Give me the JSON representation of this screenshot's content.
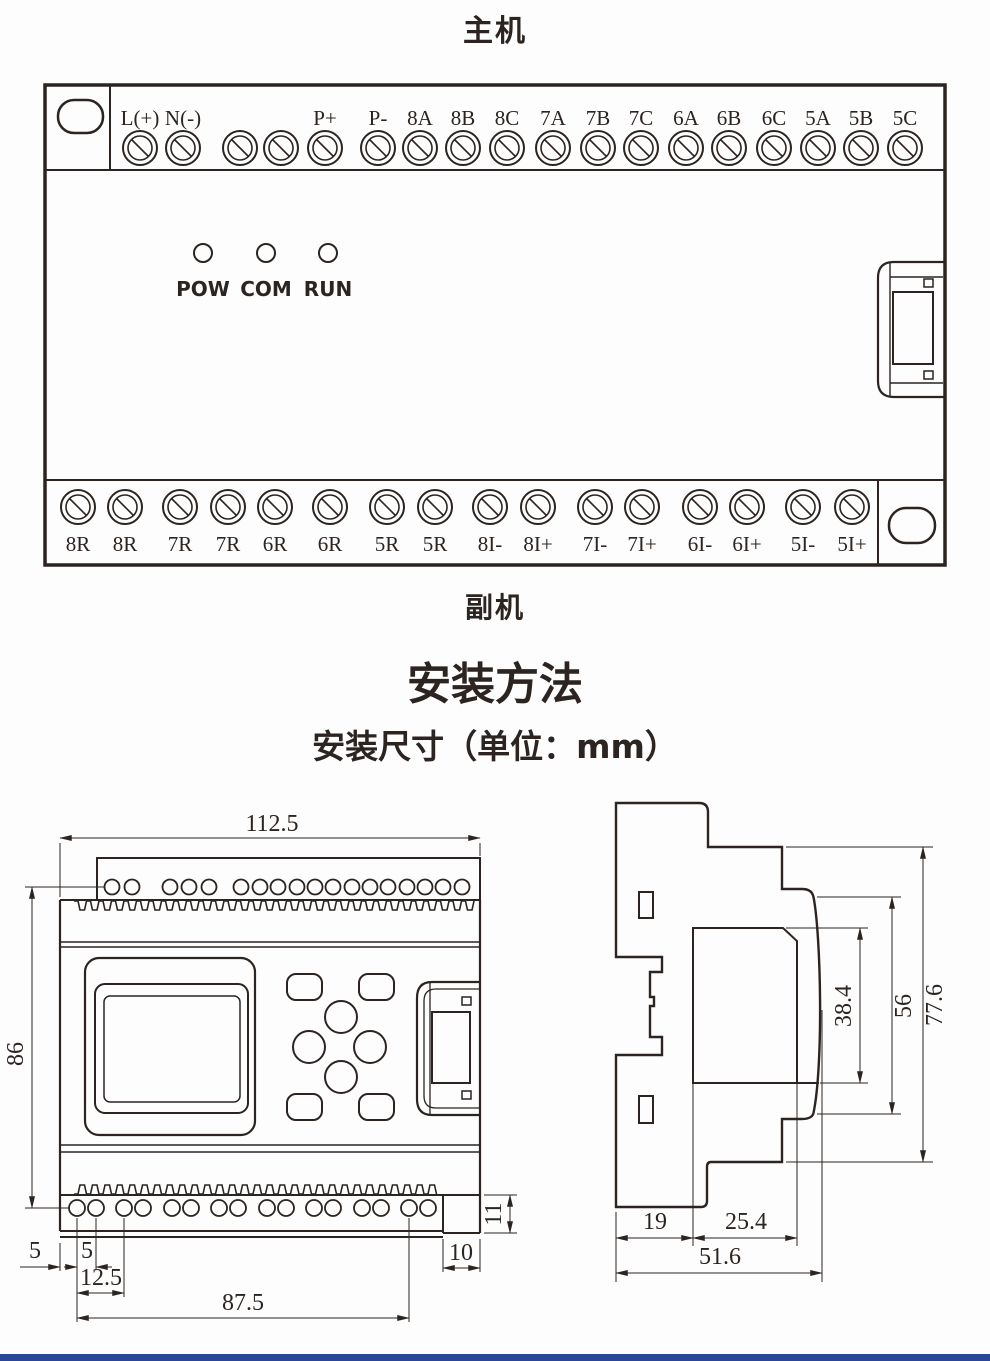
{
  "page": {
    "background": "#fdfdfd",
    "line_color": "#2b2420",
    "footer_bar_color": "#2a4795"
  },
  "titles": {
    "main_unit": "主机",
    "sub_unit": "副机",
    "install_section": "安装方法",
    "dims_section": "安装尺寸（单位：mm）"
  },
  "main_unit": {
    "top_terminals": [
      "L(+)",
      "N(-)",
      "",
      "",
      "P+",
      "P-",
      "8A",
      "8B",
      "8C",
      "7A",
      "7B",
      "7C",
      "6A",
      "6B",
      "6C",
      "5A",
      "5B",
      "5C"
    ],
    "leds": [
      "POW",
      "COM",
      "RUN"
    ],
    "bottom_terminals": [
      "8R",
      "8R",
      "7R",
      "7R",
      "6R",
      "6R",
      "5R",
      "5R",
      "8I-",
      "8I+",
      "7I-",
      "7I+",
      "6I-",
      "6I+",
      "5I-",
      "5I+"
    ]
  },
  "front_view": {
    "dim_width": "112.5",
    "dim_height": "86",
    "dim_edge_to_hole": "5",
    "dim_hole_pitch": "5",
    "dim_first_group": "12.5",
    "dim_hole_span": "87.5",
    "dim_tab_width": "10",
    "dim_tab_height": "11"
  },
  "side_view": {
    "dim_panel_height": "38.4",
    "dim_body_height": "56",
    "dim_total_height": "77.6",
    "dim_left_depth": "19",
    "dim_mid_depth": "25.4",
    "dim_total_depth": "51.6"
  }
}
